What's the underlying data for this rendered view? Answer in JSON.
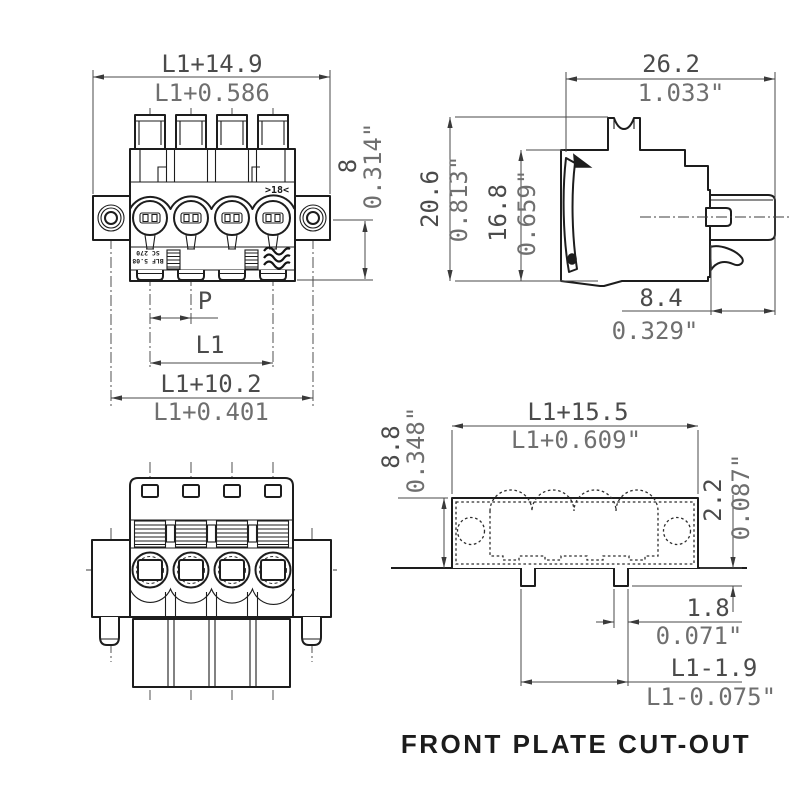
{
  "front": {
    "width_mm": "L1+14.9",
    "width_in": "L1+0.586",
    "height_mm": "8",
    "height_in": "0.314\"",
    "pitch_label": "P",
    "length_label": "L1",
    "hole_span_mm": "L1+10.2",
    "hole_span_in": "L1+0.401",
    "material_marking": ">18<",
    "body_marking_1": "SC 270",
    "body_marking_2": "BLF 5.08"
  },
  "side": {
    "width_mm": "26.2",
    "width_in": "1.033\"",
    "height_mm": "20.6",
    "height_in": "0.813\"",
    "lever_mm": "16.8",
    "lever_in": "0.659\"",
    "nose_mm": "8.4",
    "nose_in": "0.329\""
  },
  "cutout": {
    "width_mm": "L1+15.5",
    "width_in": "L1+0.609\"",
    "height_mm": "8.8",
    "height_in": "0.348\"",
    "tab_height_mm": "2.2",
    "tab_height_in": "0.087\"",
    "tab_width_mm": "1.8",
    "tab_width_in": "0.071\"",
    "tab_span_mm": "L1-1.9",
    "tab_span_in": "L1-0.075\"",
    "caption": "FRONT PLATE CUT-OUT"
  },
  "colors": {
    "outline": "#1d1d1d",
    "dimension_metric": "#4b4b4b",
    "dimension_inch": "#6f6f6f",
    "background": "#ffffff"
  }
}
